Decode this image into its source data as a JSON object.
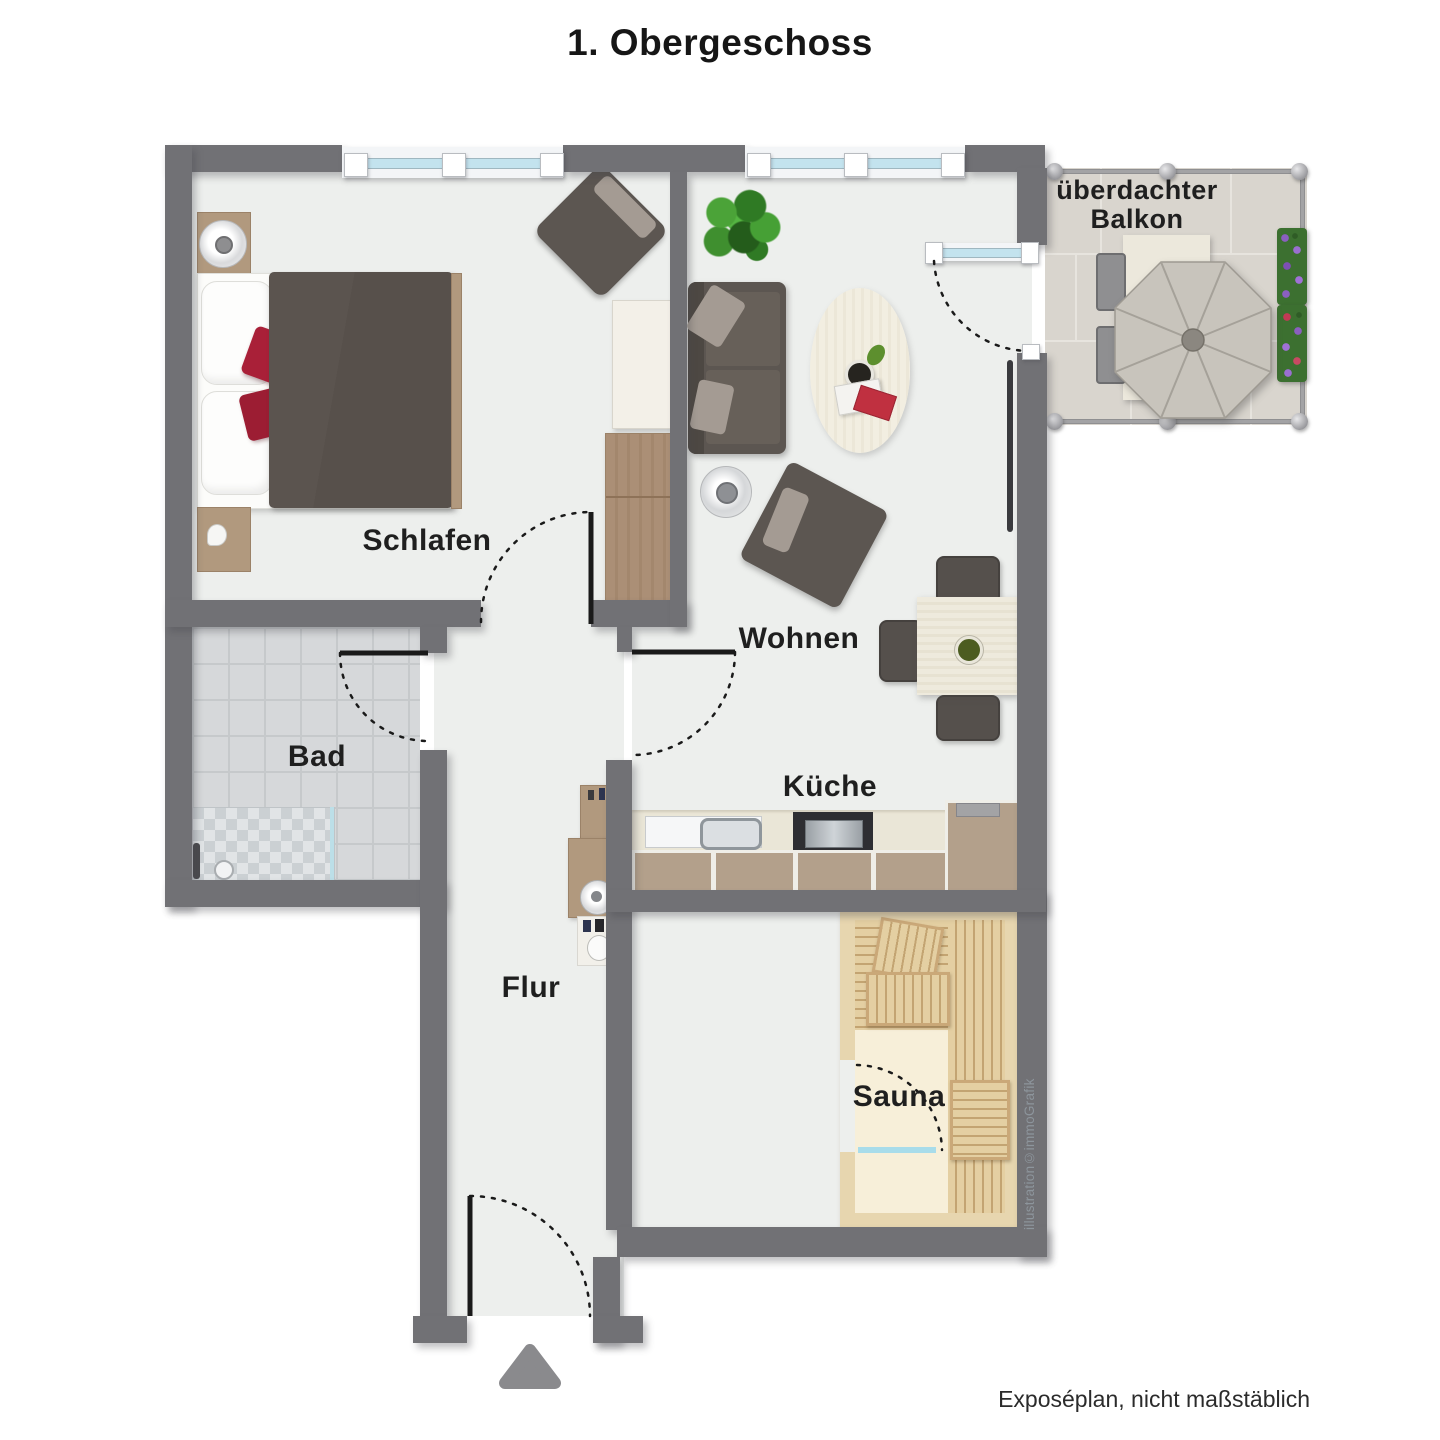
{
  "title": "1. Obergeschoss",
  "rooms": {
    "schlafen": "Schlafen",
    "bad": "Bad",
    "flur": "Flur",
    "wohnen": "Wohnen",
    "kueche": "Küche",
    "sauna": "Sauna"
  },
  "balcony": {
    "line1": "überdachter",
    "line2": "Balkon"
  },
  "credit": "illustration©immoGrafik",
  "footer": "Exposéplan, nicht maßstäblich",
  "icons": {
    "entrance_arrow": "triangle-up"
  },
  "colors": {
    "wall": "#717175",
    "floor": "#edefed",
    "bath_tile": "#d6d8da",
    "wood": "#b1997e",
    "kitchen_cabinet": "#b3a08b",
    "sauna_wall": "#e7d6af",
    "sauna_floor": "#f7efd9",
    "bench_wood": "#e4cfa2",
    "duvet": "#57504b",
    "pillow_red": "#a92038",
    "sofa": "#5c5651",
    "cushion_light": "#a49b93",
    "rug_cream": "#f1ede0",
    "glass": "#c3e3ee",
    "balcony_tile": "#d9d5ce",
    "umbrella": "#c8c4bc",
    "plant_green": "#3f8f2f",
    "flower_purple": "#8b5fbf"
  }
}
